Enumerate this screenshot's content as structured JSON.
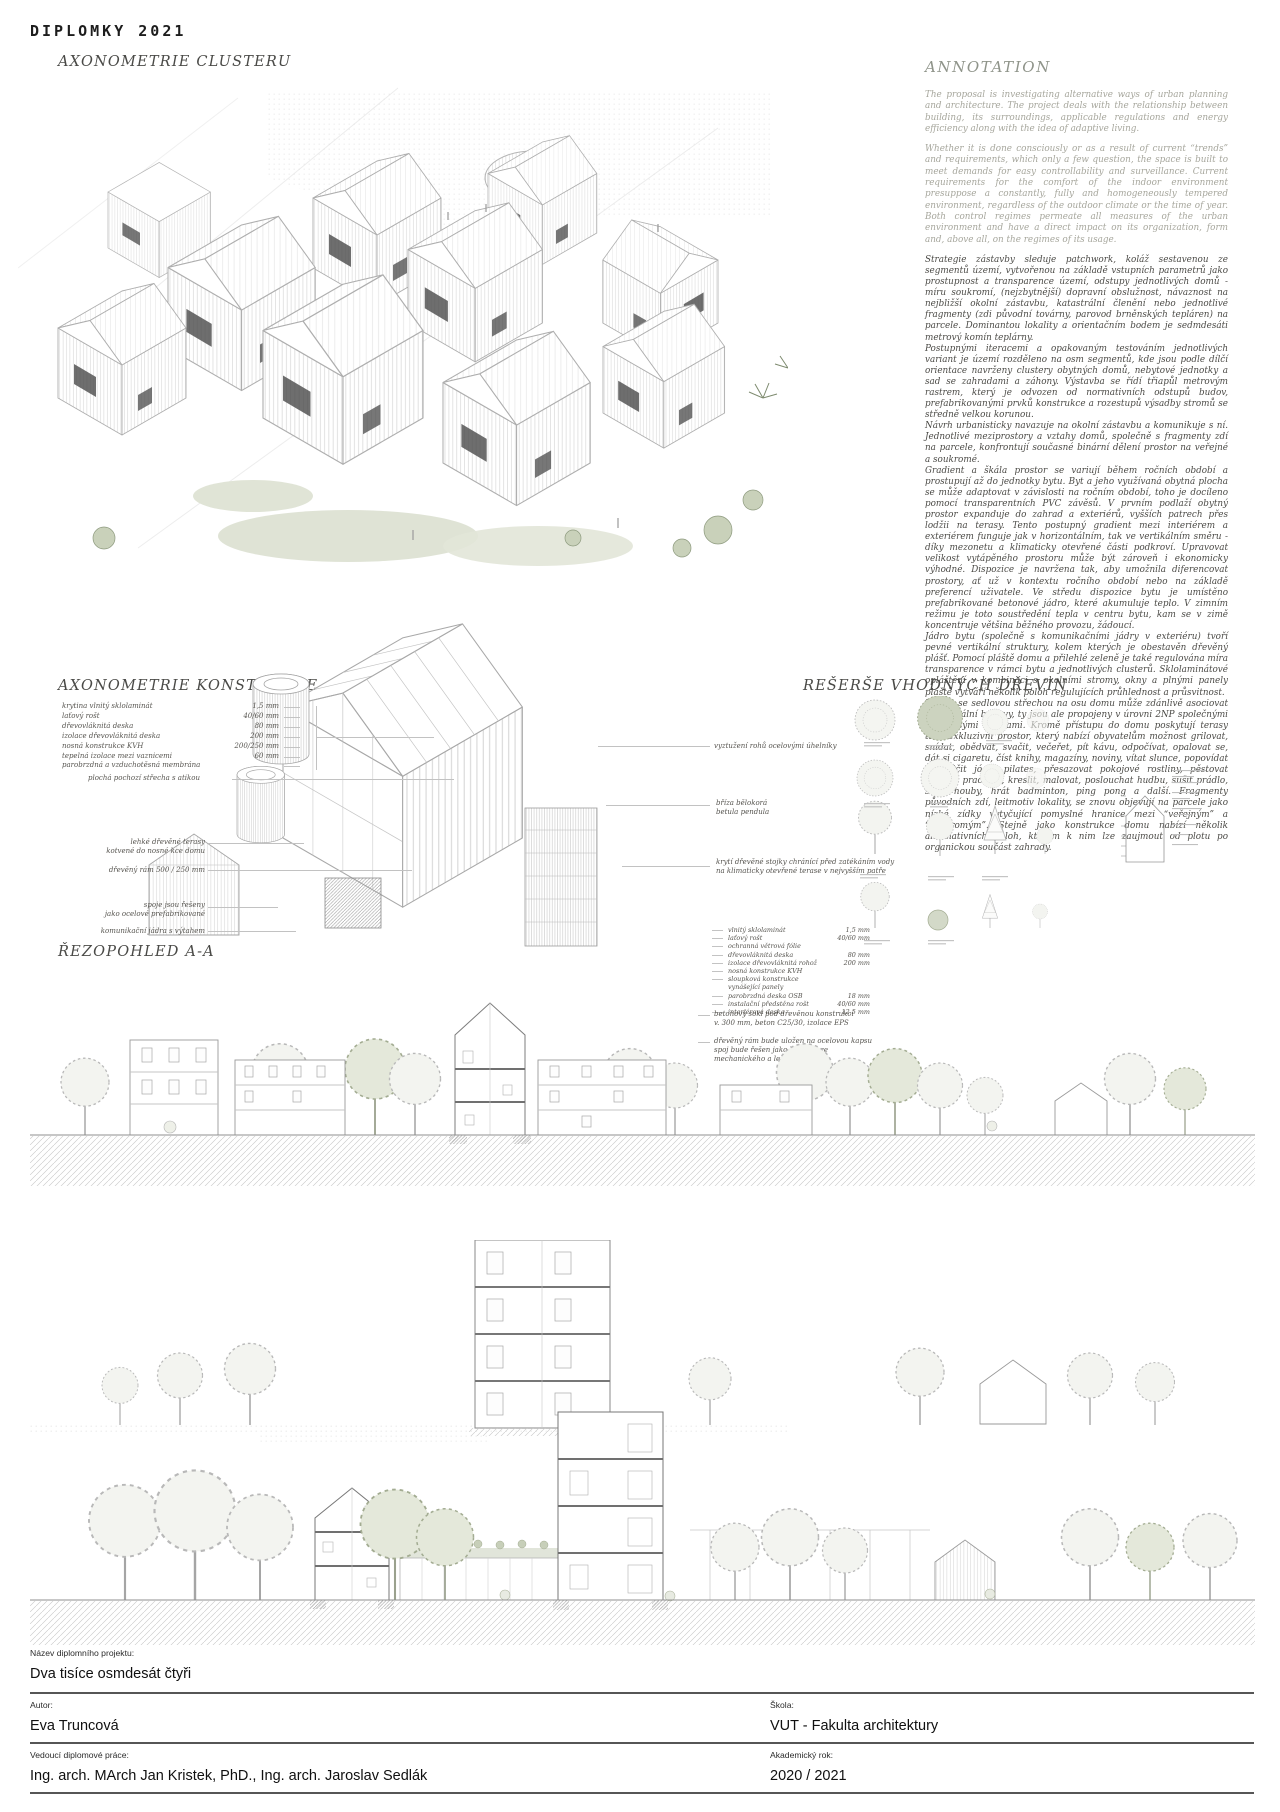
{
  "header": {
    "title": "DIPLOMKY 2021"
  },
  "cluster": {
    "title": "AXONOMETRIE CLUSTERU"
  },
  "annotation": {
    "title": "ANNOTATION",
    "english": [
      "The proposal is investigating alternative ways of urban planning and architecture. The project deals with the relationship between building, its surroundings, applicable regulations and energy efficiency along with the idea of adaptive living.",
      "Whether it is done consciously or as a result of current “trends” and requirements, which only a few question, the space is built to meet demands for easy controllability and surveillance. Current requirements for the comfort of the indoor environment presuppose a constantly, fully and homogeneously tempered environment, regardless of the outdoor climate or the time of year. Both control regimes permeate all measures of the urban environment and have a direct impact on its organization, form and, above all, on the regimes of its usage."
    ],
    "czech": [
      "Strategie zástavby sleduje patchwork, koláž sestavenou ze segmentů území, vytvořenou na základě vstupních parametrů jako prostupnost a transparence území, odstupy jednotlivých domů - míru soukromí, (nejzbytnější) dopravní obslužnost, návaznost na nejbližší okolní zástavbu, katastrální členění nebo jednotlivé fragmenty (zdi původní továrny, parovod brněnských tepláren) na parcele. Dominantou lokality a orientačním bodem je sedmdesáti metrový komín teplárny.",
      "Postupnými iteracemi a opakovaným testováním jednotlivých variant je území rozděleno na osm segmentů, kde jsou podle dílčí orientace navrženy clustery obytných domů, nebytové jednotky a sad se zahradami a záhony. Výstavba se řídí třiapůl metrovým rastrem, který je odvozen od normativních odstupů budov, prefabrikovanými prvků konstrukce a rozestupů výsadby stromů se středně velkou korunou.",
      "Návrh urbanisticky navazuje na okolní zástavbu a komunikuje s ní. Jednotlivé meziprostory a vztahy domů, společně s fragmenty zdí na parcele, konfrontují současné binární dělení prostor na veřejné a soukromé.",
      "Gradient a škála prostor se variují během ročních období a prostupují až do jednotky bytu. Byt a jeho využívaná obytná plocha se může adaptovat v závislosti na ročním období, toho je docíleno pomocí transparentních PVC závěsů. V prvním podlaží obytný prostor expanduje do zahrad a exteriérů, vyšších patrech přes lodžii na terasy. Tento postupný gradient mezi interiérem a exteriérem funguje jak v horizontálním, tak ve vertikálním směru - díky mezonetu a klimaticky otevřené části podkroví. Upravovat velikost vytápěného prostoru může být zároveň i ekonomicky výhodné. Dispozice je navržena tak, aby umožnila diferencovat prostory, ať už v kontextu ročního období nebo na základě preferencí uživatele. Ve středu dispozice bytu je umístěno prefabrikované betonové jádro, které akumuluje teplo. V zimním režimu je toto soustředění tepla v centru bytu, kam se v zimě koncentruje většina běžného provozu, žádoucí.",
      "Jádro bytu (společně s komunikačními jádry v exteriéru) tvoří pevné vertikální struktury, kolem kterých je obestavěn dřevěný plášť. Pomocí pláště domu a přilehlé zeleně je také regulována míra transparence v rámci bytu a jednotlivých clusterů. Sklolaminátové opláštění v kombinaci s okolními stromy, okny a plnými panely pláště vytváří několik poloh regulujících průhlednost a průsvitnost.",
      "Figura se sedlovou střechou na osu domu může zdánlivě asociovat individuální budovy, ty jsou ale propojeny v úrovni 2NP společnými velkorysými terasami. Kromě přístupu do domu poskytují terasy také exkluzivní prostor, který nabízí obyvatelům možnost grilovat, snídat, obědvat, svačit, večeřet, pít kávu, odpočívat, opalovat se, dát si cigaretu, číst knihy, magazíny, noviny, vítat slunce, popovídat si, cvičit jógu, pilates, přesazovat pokojové rostliny, pěstovat bylinky, pracovat, kreslit, malovat, poslouchat hudbu, sušit prádlo, sušit houby, hrát badminton, ping pong a další. Fragmenty původních zdí, leitmotiv lokality, se znovu objevují na parcele jako nízké zídky vytyčující pomyslné hranice mezi “veřejným” a “soukromým”. Stejně jako konstrukce domu nabízí několik alternativních poloh, kterým k nim lze zaujmout od plotu po organickou součást zahrady."
    ]
  },
  "konstrukce": {
    "title": "AXONOMETRIE KONSTRUKCE",
    "materials_roof": [
      {
        "label": "krytina vlnitý sklolaminát",
        "value": "1,5 mm"
      },
      {
        "label": "laťový rošt",
        "value": "40/60 mm"
      },
      {
        "label": "dřevovláknitá deska",
        "value": "80 mm"
      },
      {
        "label": "izolace dřevovláknitá deska",
        "value": "200 mm"
      },
      {
        "label": "nosná konstrukce KVH",
        "value": "200/250 mm"
      },
      {
        "label": "tepelná izolace mezi vaznicemi",
        "value": "60 mm"
      },
      {
        "label": "parobrzdná a vzduchotěsná membrána",
        "value": ""
      }
    ],
    "label_flat_roof": "plochá pochozí střecha s atikou",
    "labels_left": [
      [
        "lehké dřevěné terasy",
        "kotvené do nosné kce domu"
      ],
      [
        "dřevěný rám 500 / 250 mm"
      ],
      [
        "spoje jsou řešeny",
        "jako ocelové prefabrikované"
      ],
      [
        "komunikační jádra s výtahem"
      ]
    ],
    "labels_right": [
      [
        "vyztužení rohů ocelovými úhelníky"
      ],
      [
        "bříza bělokorá",
        "betula pendula"
      ],
      [
        "krytí dřevěné stojky chránící před zatékáním vody",
        "na klimaticky otevřené terase v nejvyšším patře"
      ]
    ],
    "materials_wall": [
      {
        "label": "vlnitý sklolaminát",
        "value": "1,5 mm"
      },
      {
        "label": "laťový rošt",
        "value": "40/60 mm"
      },
      {
        "label": "ochranná větrová fólie",
        "value": ""
      },
      {
        "label": "dřevovláknitá deska",
        "value": "80 mm"
      },
      {
        "label": "izolace dřevovláknitá rohož",
        "value": "200 mm"
      },
      {
        "label": "nosná konstrukce KVH",
        "value": ""
      },
      {
        "label": "sloupková konstrukce vynášející panely",
        "value": ""
      },
      {
        "label": "parobrzdná deska OSB",
        "value": "18 mm"
      },
      {
        "label": "instalační předstěna rošt",
        "value": "40/60 mm"
      },
      {
        "label": "interiérová deska",
        "value": "12,5 mm"
      }
    ],
    "note_plinth": [
      "betonový sokl pod dřevěnou konstrukcí",
      "v. 300 mm, beton C25/30, izolace EPS"
    ],
    "note_frame": [
      "dřevěný rám bude uložen na ocelovou kapsu",
      "spoj bude řešen jako kombinace",
      "mechanického a lepeného"
    ]
  },
  "dreviny": {
    "title": "REŠERŠE VHODNÝCH DŘEVIN"
  },
  "rez": {
    "title": "ŘEZOPOHLED A-A"
  },
  "footer": {
    "project_label": "Název diplomního projektu:",
    "project_name": "Dva tisíce osmdesát čtyři",
    "author_label": "Autor:",
    "author": "Eva Truncová",
    "school_label": "Škola:",
    "school": "VUT - Fakulta architektury",
    "supervisor_label": "Vedoucí diplomové práce:",
    "supervisor": "Ing. arch. MArch Jan Kristek, PhD., Ing. arch. Jaroslav Sedlák",
    "year_label": "Akademický rok:",
    "year": "2020 / 2021"
  }
}
